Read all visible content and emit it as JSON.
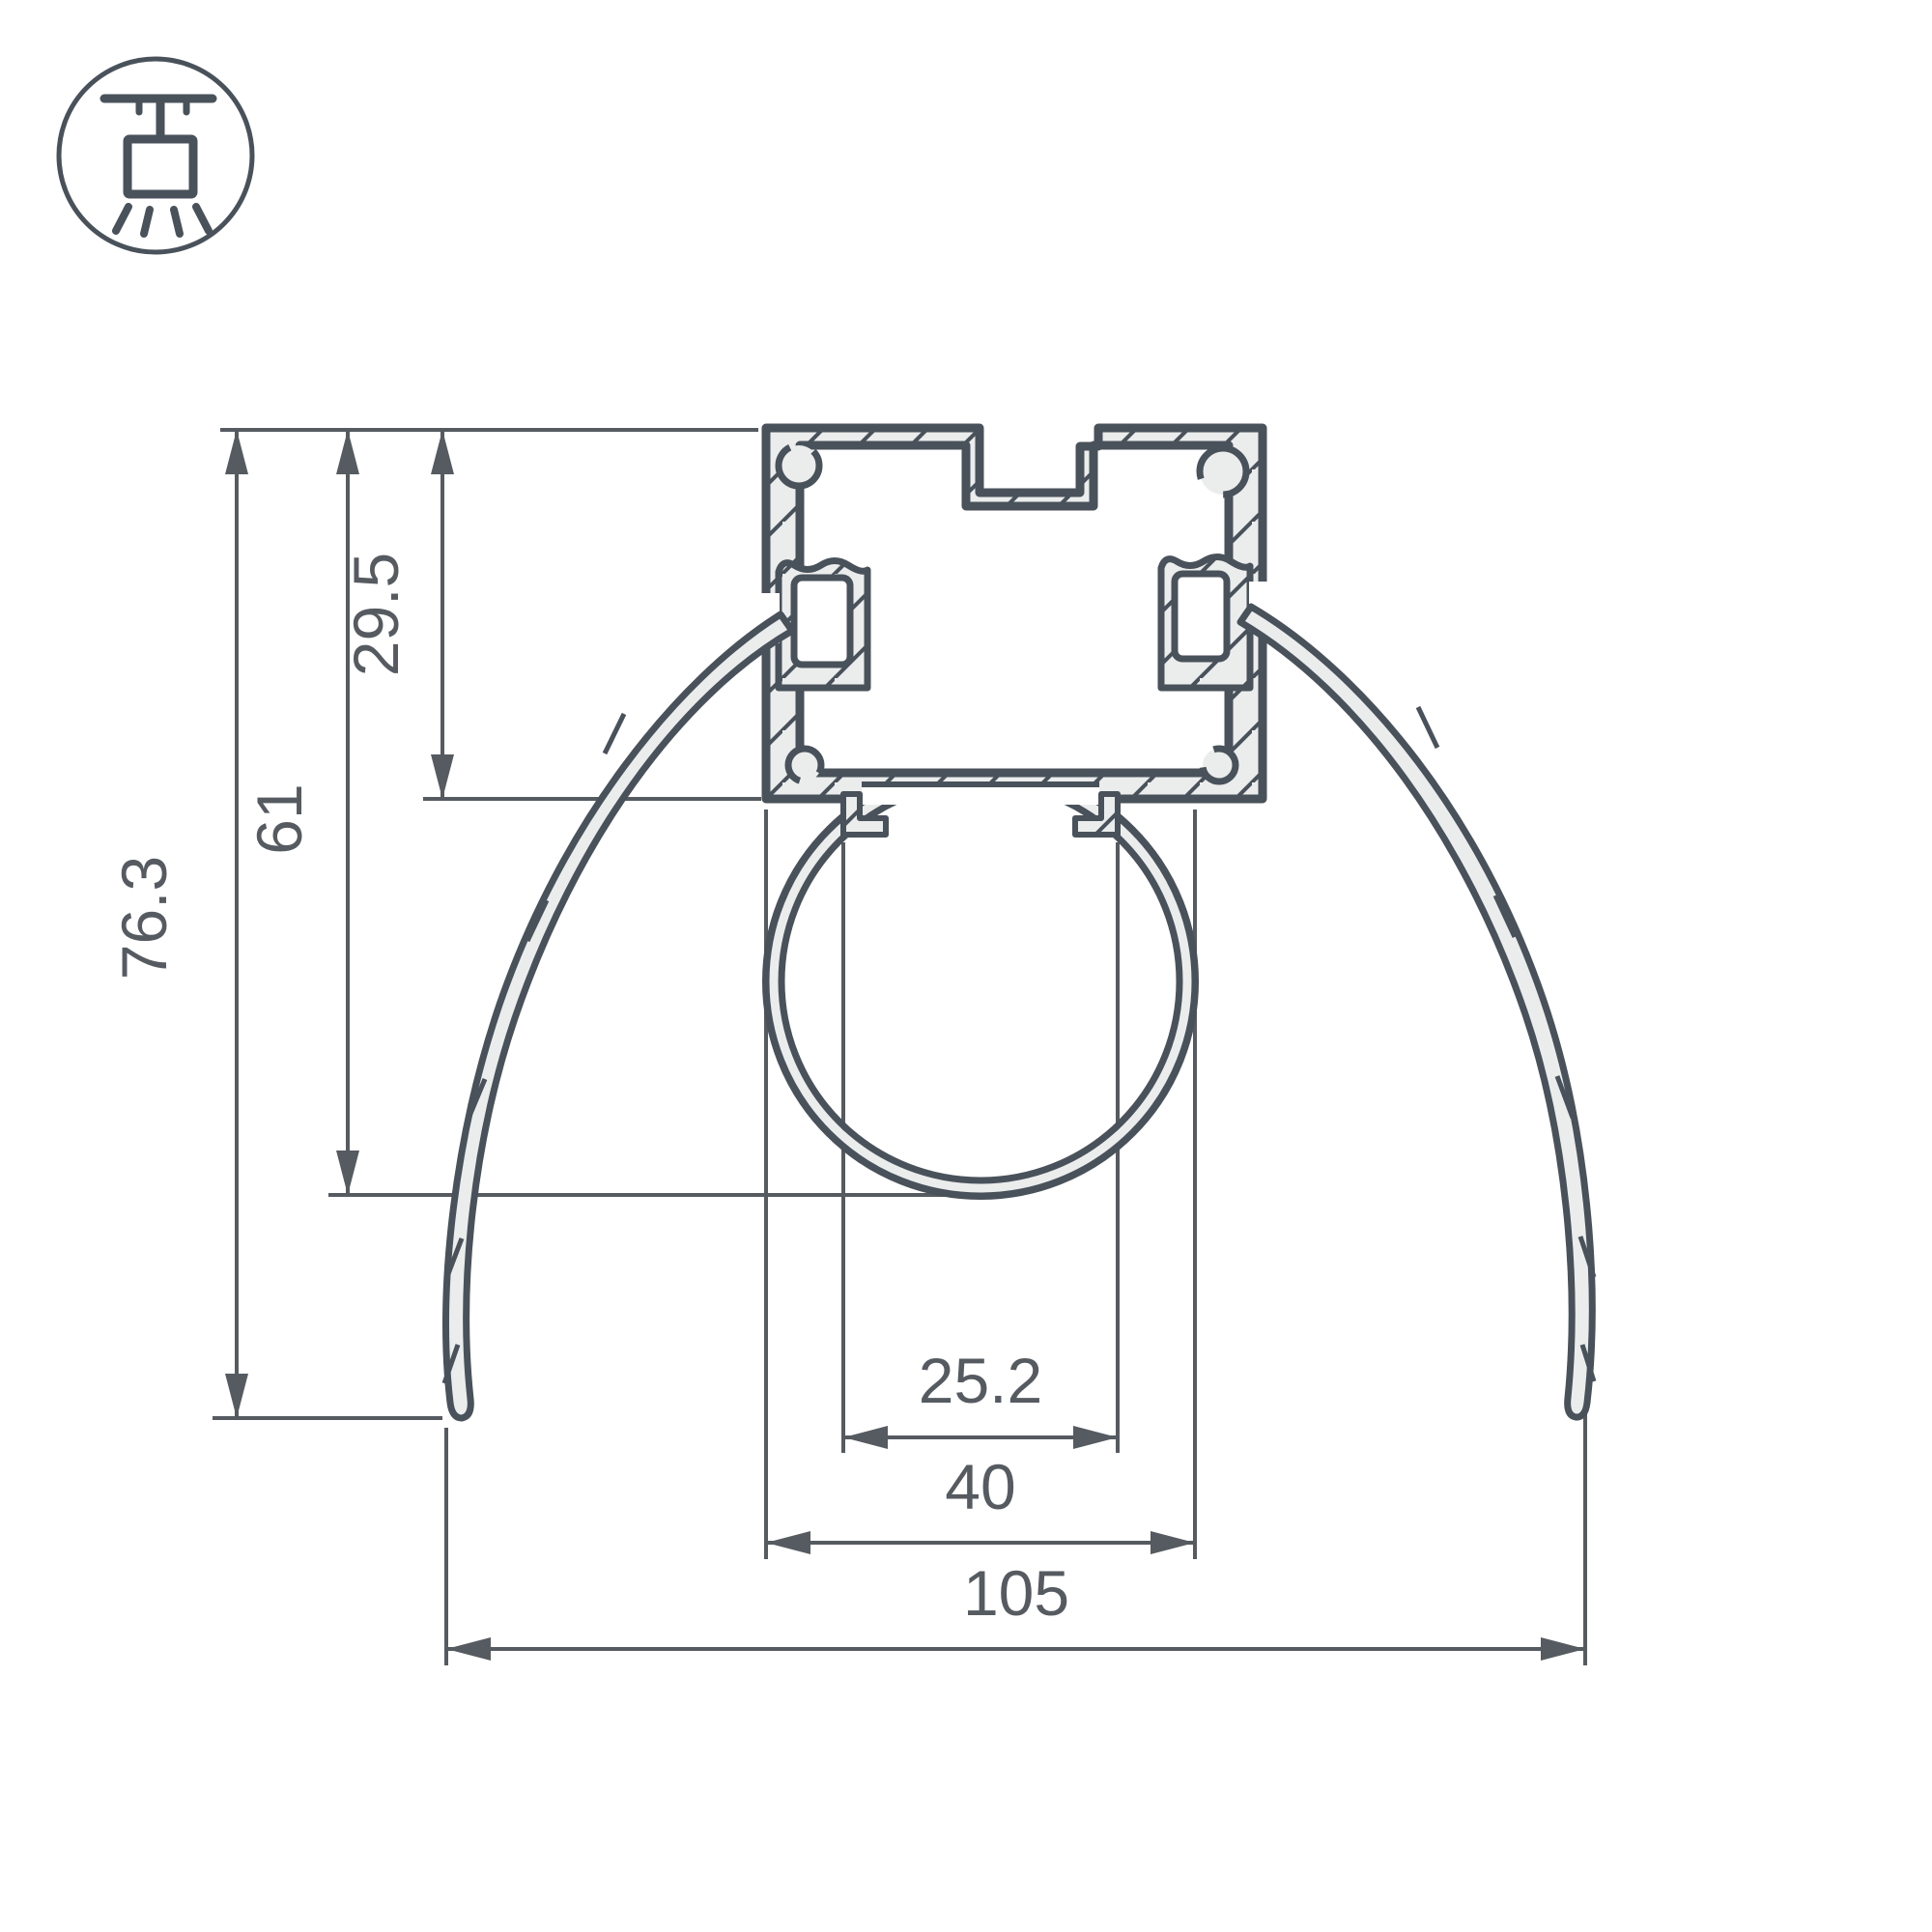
{
  "drawing": {
    "title": "suspended-led-profile-cross-section",
    "background": "#FFFFFF",
    "line_color": "#49525A",
    "dim_color": "#555B60",
    "metal_fill": "#EBEDED",
    "icon": {
      "name": "ceiling-pendant-light-icon"
    },
    "dims": {
      "height_overall": {
        "label": "76.3"
      },
      "height_to_tube_bottom": {
        "label": "61"
      },
      "height_body": {
        "label": "29.5"
      },
      "width_tube_clip": {
        "label": "25.2"
      },
      "width_tube": {
        "label": "40"
      },
      "width_overall": {
        "label": "105"
      }
    }
  }
}
